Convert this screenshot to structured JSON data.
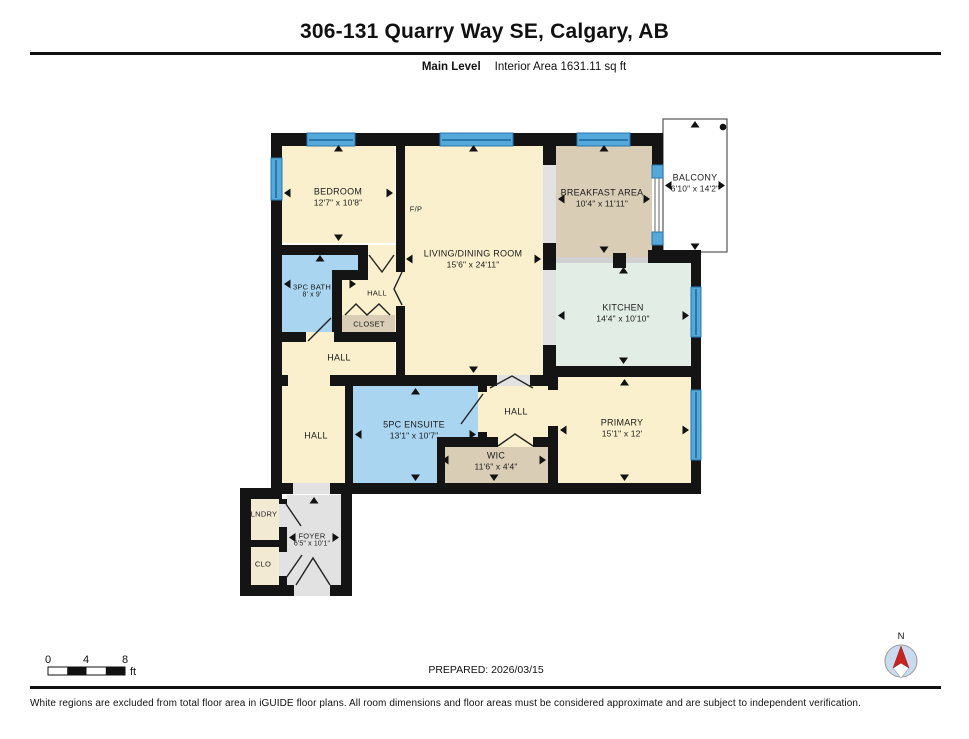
{
  "header": {
    "title": "306-131 Quarry Way SE, Calgary, AB",
    "level_label": "Main Level",
    "area_label": "Interior Area 1631.11 sq ft"
  },
  "rooms": {
    "bedroom": {
      "name": "BEDROOM",
      "dims": "12'7\" x 10'8\""
    },
    "living": {
      "name": "LIVING/DINING ROOM",
      "dims": "15'6\" x 24'11\""
    },
    "breakfast": {
      "name": "BREAKFAST AREA",
      "dims": "10'4\" x 11'11\""
    },
    "balcony": {
      "name": "BALCONY",
      "dims": "6'10\" x 14'2\""
    },
    "kitchen": {
      "name": "KITCHEN",
      "dims": "14'4\" x 10'10\""
    },
    "primary": {
      "name": "PRIMARY",
      "dims": "15'1\" x 12'"
    },
    "bath": {
      "name": "3PC BATH",
      "dims": "8' x 9'"
    },
    "ensuite": {
      "name": "5PC ENSUITE",
      "dims": "13'1\" x 10'7\""
    },
    "wic": {
      "name": "WIC",
      "dims": "11'6\" x 4'4\""
    },
    "foyer": {
      "name": "FOYER",
      "dims": "6'5\" x 10'1\""
    },
    "hall_top": {
      "name": "HALL"
    },
    "hall_mid": {
      "name": "HALL"
    },
    "hall_left": {
      "name": "HALL"
    },
    "hall_right": {
      "name": "HALL"
    },
    "closet": {
      "name": "CLOSET"
    },
    "lndry": {
      "name": "LNDRY"
    },
    "clo": {
      "name": "CLO"
    },
    "fireplace": {
      "name": "F/P"
    }
  },
  "scale_bar": {
    "tick0": "0",
    "tick4": "4",
    "tick8": "8",
    "unit": "ft"
  },
  "compass": {
    "north": "N"
  },
  "footer": {
    "prepared": "PREPARED: 2026/03/15",
    "disclaimer": "White regions are excluded from total floor area in iGUIDE floor plans. All room dimensions and floor areas must be considered approximate and are subject to independent verification."
  },
  "palette": {
    "wall": "#141414",
    "cream": "#FAF0CD",
    "tan": "#D9CDB6",
    "sage": "#E2EDE5",
    "blue_room": "#A9D5F1",
    "gray_floor": "#E2E2E2",
    "beige": "#F3EAD3",
    "window": "#55A9DA",
    "window_dark": "#2878AE",
    "compass_fill": "#C9DCEF",
    "compass_needle": "#CC2222"
  }
}
